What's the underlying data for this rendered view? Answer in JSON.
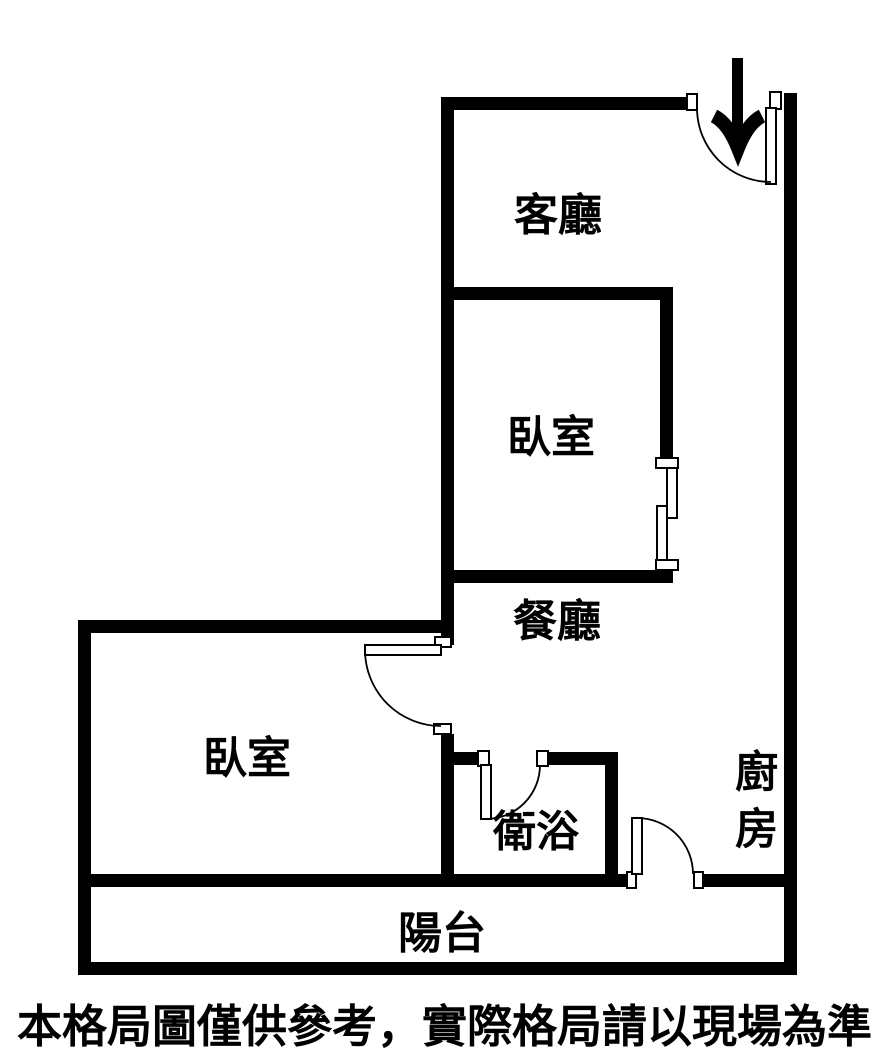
{
  "floorplan": {
    "labels": {
      "living_room": "客廳",
      "bedroom_upper": "臥室",
      "dining_room": "餐廳",
      "bedroom_left": "臥室",
      "bathroom": "衛浴",
      "kitchen": "廚房",
      "balcony": "陽台"
    },
    "disclaimer": "本格局圖僅供參考，實際格局請以現場為準",
    "colors": {
      "wall": "#000000",
      "background": "#ffffff",
      "text": "#000000"
    }
  }
}
